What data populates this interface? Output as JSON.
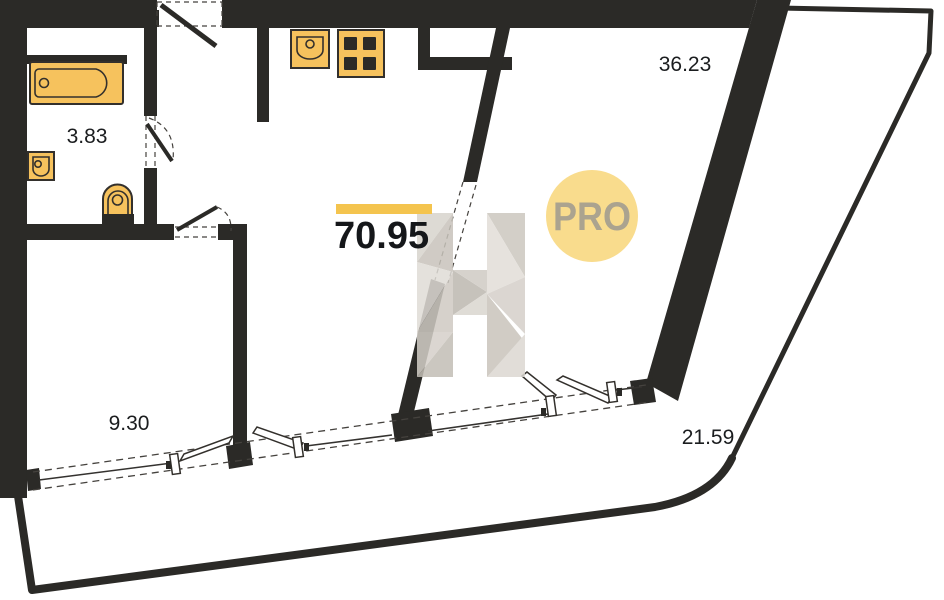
{
  "plan": {
    "type": "apartment-floor-plan",
    "total_area": "70.95",
    "badge_label": "PRO",
    "rooms": [
      {
        "id": "bathroom",
        "area": "3.83"
      },
      {
        "id": "room",
        "area": "9.30"
      },
      {
        "id": "living-kitchen",
        "area": "36.23"
      },
      {
        "id": "terrace",
        "area": "21.59"
      }
    ],
    "fixtures": [
      "bathtub",
      "washbasin",
      "toilet",
      "kitchen-sink",
      "stove"
    ],
    "colors": {
      "wall": "#2b2a27",
      "fixture_fill": "#f6c25d",
      "highlight_bar": "#f4c44e",
      "badge_fill": "#f9dc8d",
      "badge_text": "#aba38f",
      "watermark_gray": "#d6d2cb"
    }
  }
}
